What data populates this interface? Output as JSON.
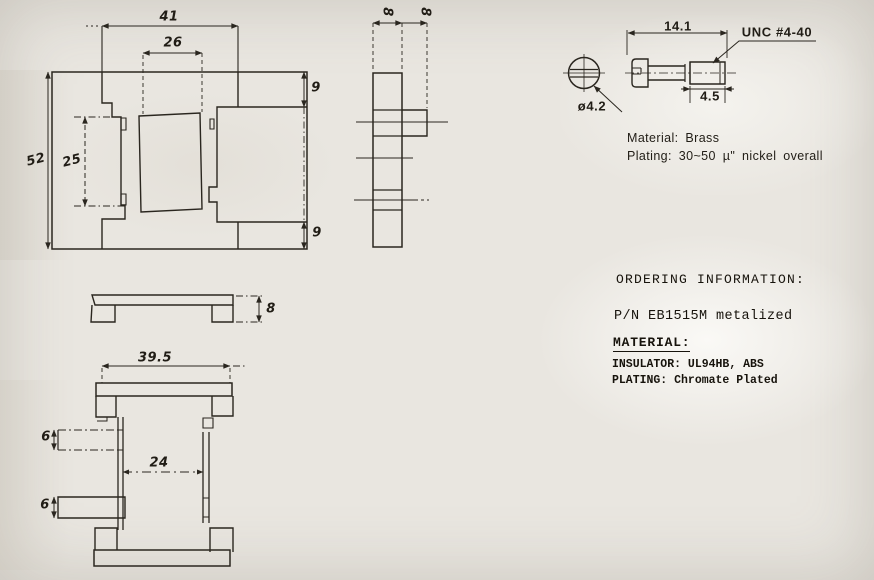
{
  "front_view": {
    "dim_width_outer": "41",
    "dim_width_opening": "26",
    "dim_flange_top": "9",
    "dim_height": "52",
    "dim_slot_height": "25",
    "dim_flange_bottom": "9"
  },
  "side_view": {
    "dim_depth_front": "8",
    "dim_depth_rear": "8"
  },
  "bracket_view": {
    "dim_height": "8"
  },
  "bottom_view": {
    "dim_width": "39.5",
    "dim_tab_upper": "6",
    "dim_inner_width": "24",
    "dim_tab_lower": "6"
  },
  "screw_detail": {
    "dim_head_dia": "ø4.2",
    "dim_length": "14.1",
    "thread_spec": "UNC #4-40",
    "dim_thread_length": "4.5",
    "material_note": "Material: Brass",
    "plating_note": "Plating: 30~50 µ\" nickel overall"
  },
  "ordering_info": {
    "heading": "ORDERING INFORMATION:",
    "part_number": "P/N EB1515M metalized",
    "material_heading": "MATERIAL:",
    "insulator_line": "INSULATOR: UL94HB, ABS",
    "plating_line": "PLATING: Chromate Plated"
  }
}
